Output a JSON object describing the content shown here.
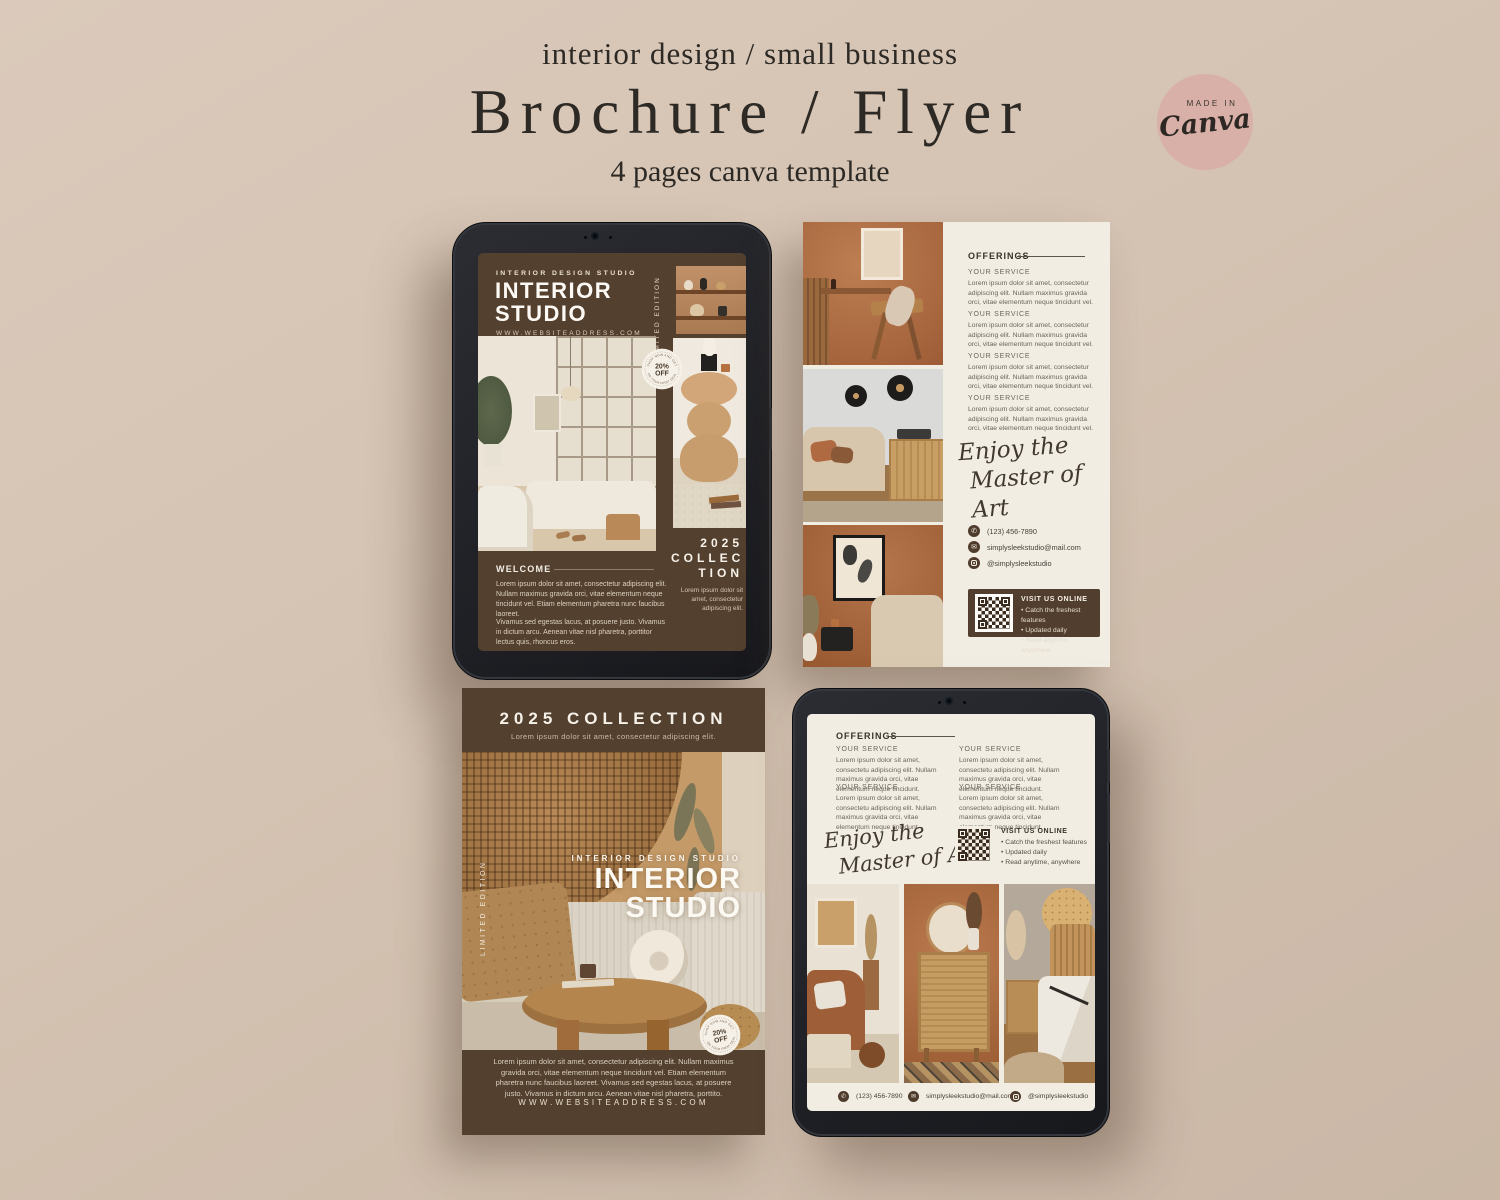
{
  "header": {
    "tagline": "interior design / small business",
    "title": "Brochure / Flyer",
    "subtitle": "4 pages canva template"
  },
  "canva_badge": {
    "label": "MADE IN",
    "brand": "Canva"
  },
  "discount_badge": {
    "arc_top": "SHOP NOW AND GET",
    "value": "20%",
    "unit": "OFF",
    "arc_bottom": "ON YOUR FIRST DEAL"
  },
  "page1": {
    "studio_label": "INTERIOR DESIGN STUDIO",
    "title_line1": "INTERIOR",
    "title_line2": "STUDIO",
    "website": "WWW.WEBSITEADDRESS.COM",
    "limited_edition": "LIMITED EDITION",
    "welcome": {
      "heading": "WELCOME",
      "para1": "Lorem ipsum dolor sit amet, consectetur adipiscing elit. Nullam maximus gravida orci, vitae elementum neque tincidunt vel. Etiam elementum pharetra nunc faucibus laoreet.",
      "para2": "Vivamus sed egestas lacus, at posuere justo. Vivamus in dictum arcu. Aenean vitae nisl pharetra, porttitor lectus quis, rhoncus eros."
    },
    "collection": {
      "line1": "2025",
      "line2": "COLLEC",
      "line3": "TION",
      "caption": "Lorem ipsum dolor sit amet, consectetur adipiscing elit."
    }
  },
  "page2": {
    "offerings_heading": "OFFERINGS",
    "services": [
      {
        "label": "YOUR SERVICE",
        "text": "Lorem ipsum dolor sit amet, consectetur adipiscing elit. Nullam maximus gravida orci, vitae elementum neque tincidunt vel."
      },
      {
        "label": "YOUR SERVICE",
        "text": "Lorem ipsum dolor sit amet, consectetur adipiscing elit. Nullam maximus gravida orci, vitae elementum neque tincidunt vel."
      },
      {
        "label": "YOUR SERVICE",
        "text": "Lorem ipsum dolor sit amet, consectetur adipiscing elit. Nullam maximus gravida orci, vitae elementum neque tincidunt vel."
      },
      {
        "label": "YOUR SERVICE",
        "text": "Lorem ipsum dolor sit amet, consectetur adipiscing elit. Nullam maximus gravida orci, vitae elementum neque tincidunt vel."
      }
    ],
    "script_line1": "Enjoy the",
    "script_line2": "Master of Art",
    "contacts": {
      "phone": "(123) 456-7890",
      "email": "simplysleekstudio@mail.com",
      "instagram": "@simplysleekstudio"
    },
    "visit": {
      "heading": "VISIT US ONLINE",
      "bullet1": "Catch the freshest features",
      "bullet2": "Updated daily",
      "bullet3": "Read anytime, anywhere"
    }
  },
  "page3": {
    "header_title": "2025 COLLECTION",
    "header_subtitle": "Lorem ipsum dolor sit amet, consectetur adipiscing elit.",
    "studio_label": "INTERIOR DESIGN STUDIO",
    "title_line1": "INTERIOR",
    "title_line2": "STUDIO",
    "limited_edition": "LIMITED EDITION",
    "footer_text": "Lorem ipsum dolor sit amet, consectetur adipiscing elit. Nullam maximus gravida orci, vitae elementum neque tincidunt vel. Etiam elementum pharetra nunc faucibus laoreet. Vivamus sed egestas lacus, at posuere justo. Vivamus in dictum arcu. Aenean vitae nisl pharetra, porttito.",
    "website": "WWW.WEBSITEADDRESS.COM"
  },
  "page4": {
    "offerings_heading": "OFFERINGS",
    "services": [
      {
        "label": "YOUR SERVICE",
        "text": "Lorem ipsum dolor sit amet, consectetu adipiscing elit. Nullam maximus gravida orci, vitae elementum neque tincidunt."
      },
      {
        "label": "YOUR SERVICE",
        "text": "Lorem ipsum dolor sit amet, consectetu adipiscing elit. Nullam maximus gravida orci, vitae elementum neque tincidunt."
      },
      {
        "label": "YOUR SERVICE",
        "text": "Lorem ipsum dolor sit amet, consectetu adipiscing elit. Nullam maximus gravida orci, vitae elementum neque tincidunt."
      },
      {
        "label": "YOUR SERVICE",
        "text": "Lorem ipsum dolor sit amet, consectetu adipiscing elit. Nullam maximus gravida orci, vitae elementum neque tincidunt."
      }
    ],
    "script_line1": "Enjoy the",
    "script_line2": "Master of Art",
    "visit": {
      "heading": "VISIT US ONLINE",
      "bullet1": "Catch the freshest features",
      "bullet2": "Updated daily",
      "bullet3": "Read anytime, anywhere"
    },
    "contacts": {
      "phone": "(123) 456-7890",
      "email": "simplysleekstudio@mail.com",
      "instagram": "@simplysleekstudio"
    }
  },
  "colors": {
    "background": "#D3C1B0",
    "brown": "#53402F",
    "cream": "#F2EDE3",
    "badge_pink": "#D8B0A8",
    "terracotta": "#A8663F"
  }
}
